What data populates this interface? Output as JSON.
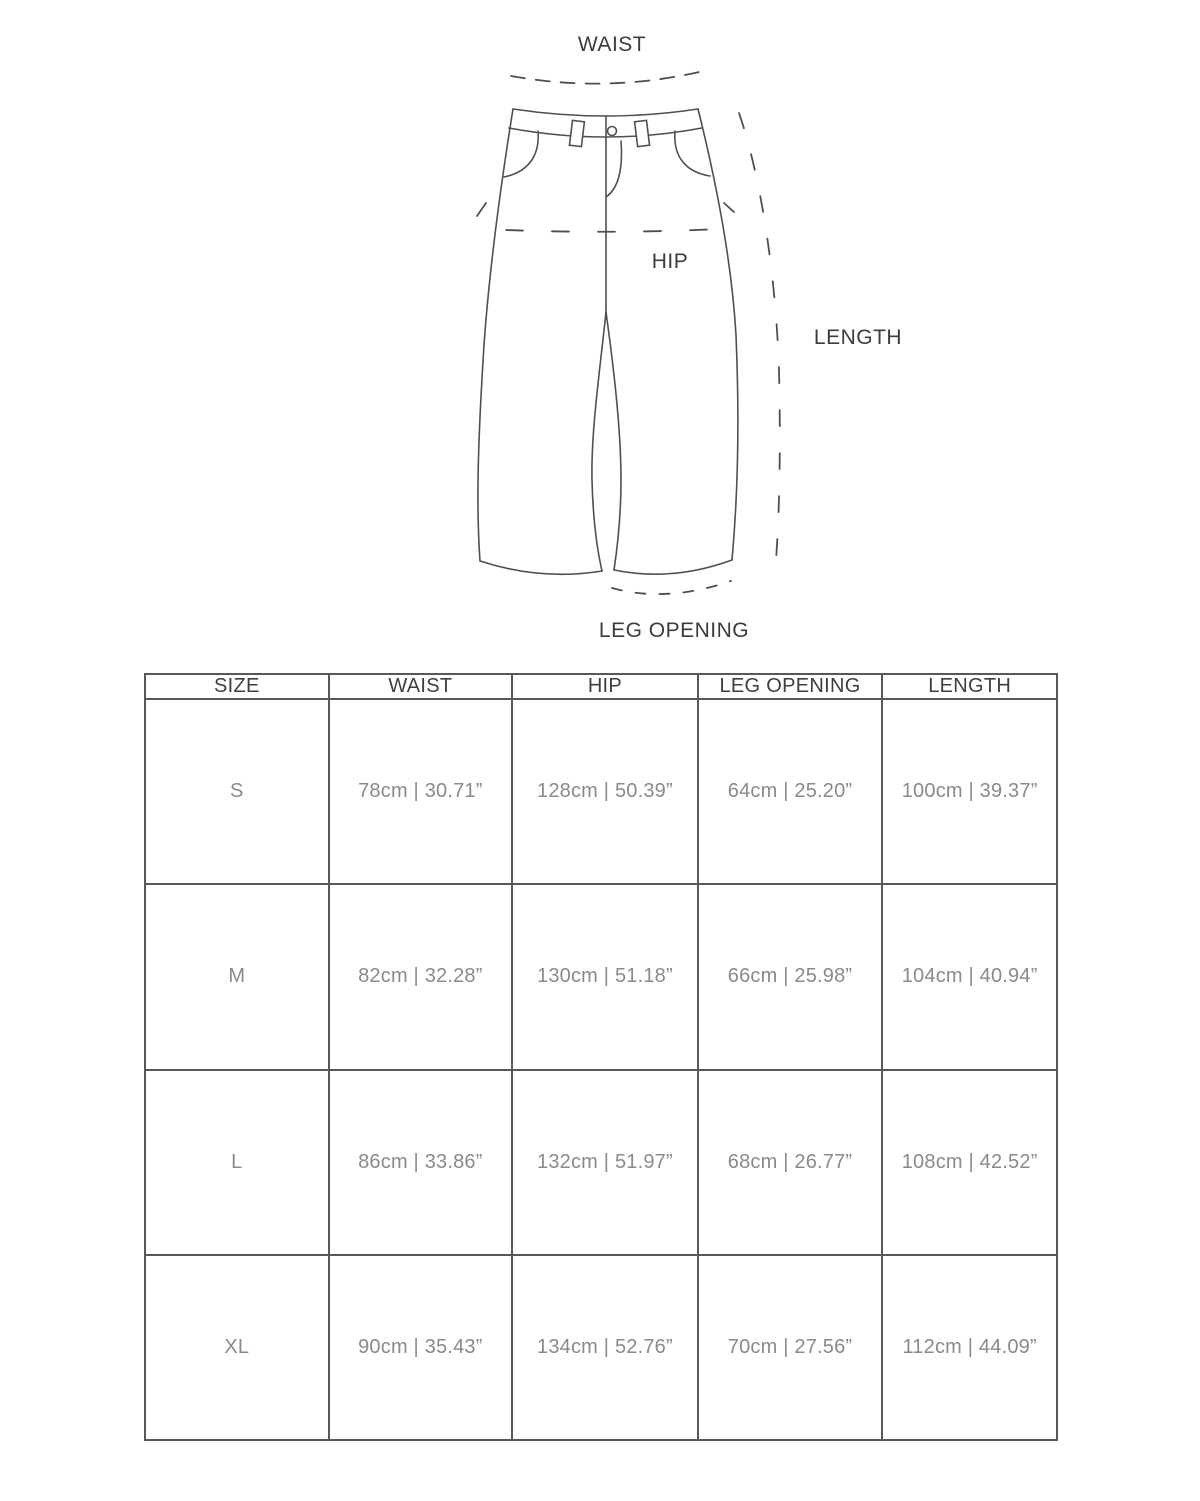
{
  "page": {
    "background_color": "#ffffff",
    "outline_color": "#4f4f4f",
    "table_border_color": "#585858",
    "header_text_color": "#3e3e3e",
    "cell_text_color": "#8a8a8a",
    "label_text_color": "#3c3c3c"
  },
  "diagram": {
    "labels": {
      "waist": "WAIST",
      "hip": "HIP",
      "length": "LENGTH",
      "leg_opening": "LEG OPENING"
    }
  },
  "size_chart": {
    "headers": [
      "SIZE",
      "WAIST",
      "HIP",
      "LEG OPENING",
      "LENGTH"
    ],
    "rows": [
      {
        "size": "S",
        "waist": "78cm | 30.71”",
        "hip": "128cm | 50.39”",
        "leg_opening": "64cm | 25.20”",
        "length": "100cm | 39.37”"
      },
      {
        "size": "M",
        "waist": "82cm | 32.28”",
        "hip": "130cm | 51.18”",
        "leg_opening": "66cm | 25.98”",
        "length": "104cm | 40.94”"
      },
      {
        "size": "L",
        "waist": "86cm | 33.86”",
        "hip": "132cm | 51.97”",
        "leg_opening": "68cm | 26.77”",
        "length": "108cm | 42.52”"
      },
      {
        "size": "XL",
        "waist": "90cm | 35.43”",
        "hip": "134cm | 52.76”",
        "leg_opening": "70cm | 27.56”",
        "length": "112cm | 44.09”"
      }
    ]
  }
}
